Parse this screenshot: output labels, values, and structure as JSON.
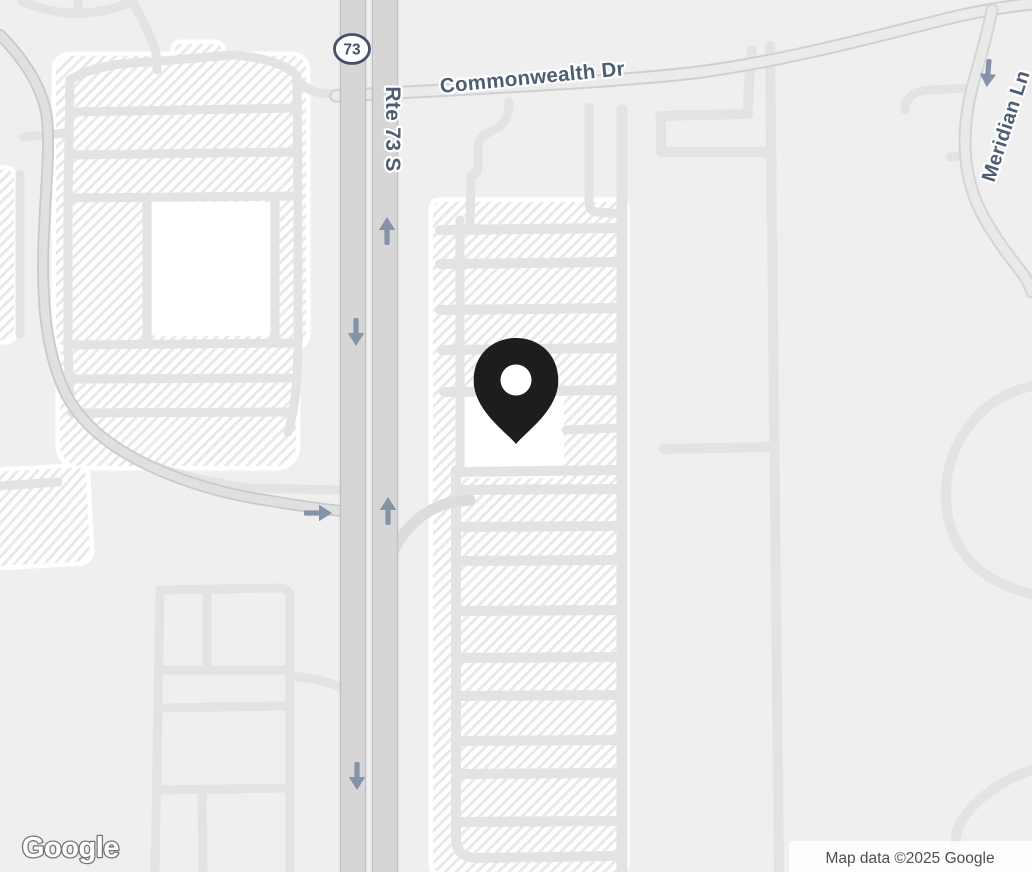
{
  "map": {
    "kind": "road-map-screenshot",
    "labels": {
      "commonwealth": "Commonwealth Dr",
      "rte73s": "Rte 73 S",
      "meridian": "Meridian Ln",
      "route_shield": "73"
    },
    "marker": {
      "description": "black location pin with white center hole",
      "color": "#1d1d1d"
    },
    "watermark": "Google",
    "attribution": "Map data ©2025 Google",
    "colors": {
      "background": "#f0efef",
      "parking_fill": "#ffffff",
      "parking_hatch": "#e8e8e8",
      "road_minor": "#e3e3e3",
      "road_collector_fill": "#e0e0e0",
      "road_collector_casing": "#c9c9c9",
      "highway_fill": "#d6d6d6",
      "highway_casing": "#bfbfbf",
      "label_text": "#4d5e74",
      "arrow": "#8493a7",
      "shield_border": "#44536b"
    }
  }
}
